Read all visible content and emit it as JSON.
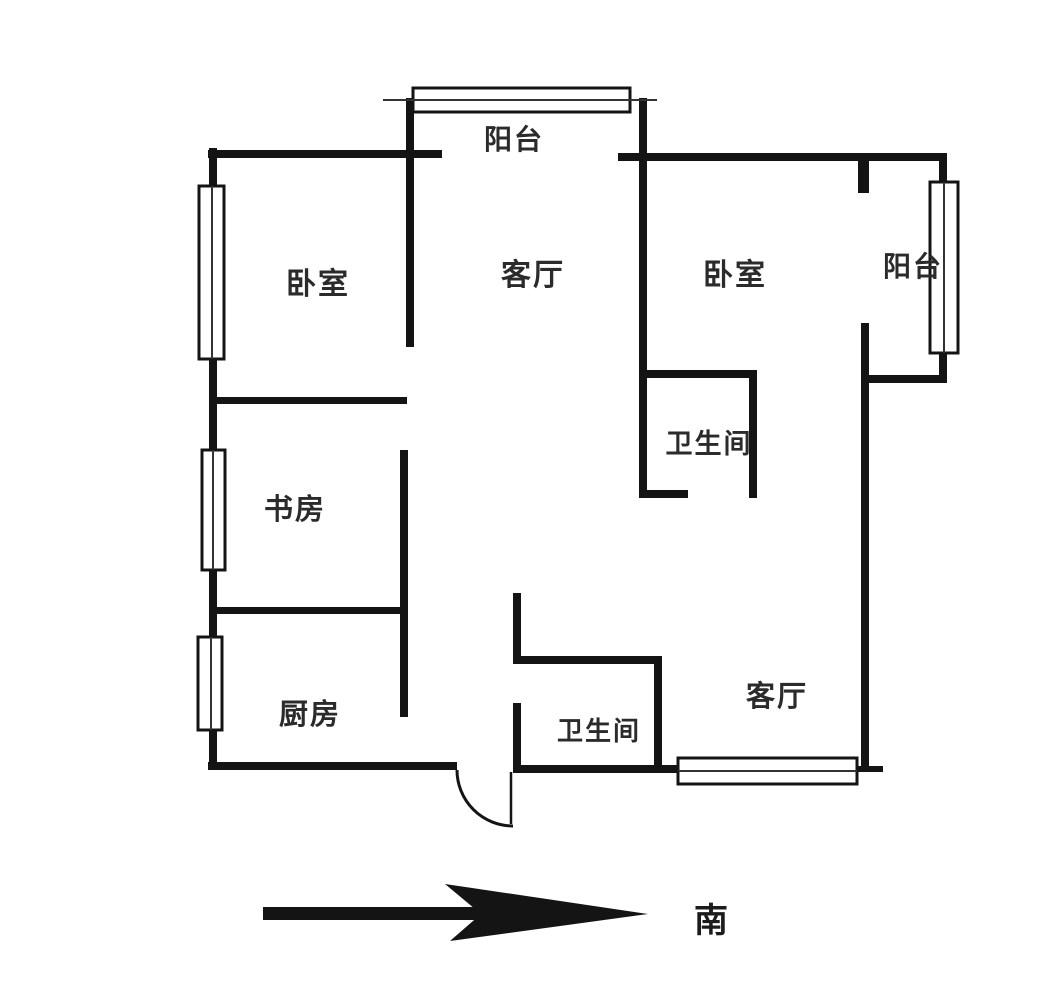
{
  "diagram": {
    "title": "apartment-floor-plan",
    "rooms": [
      {
        "id": "bedroom-left",
        "label": "卧室"
      },
      {
        "id": "living-room-top",
        "label": "客厅"
      },
      {
        "id": "bedroom-right",
        "label": "卧室"
      },
      {
        "id": "balcony-top",
        "label": "阳台"
      },
      {
        "id": "balcony-right",
        "label": "阳台"
      },
      {
        "id": "bathroom-middle",
        "label": "卫生间"
      },
      {
        "id": "study",
        "label": "书房"
      },
      {
        "id": "kitchen",
        "label": "厨房"
      },
      {
        "id": "bathroom-bottom",
        "label": "卫生间"
      },
      {
        "id": "living-room-bottom",
        "label": "客厅"
      }
    ],
    "compass": {
      "direction_label": "南"
    },
    "colors": {
      "wall": "#141414",
      "text": "#2b2b2b",
      "background": "#ffffff"
    }
  }
}
